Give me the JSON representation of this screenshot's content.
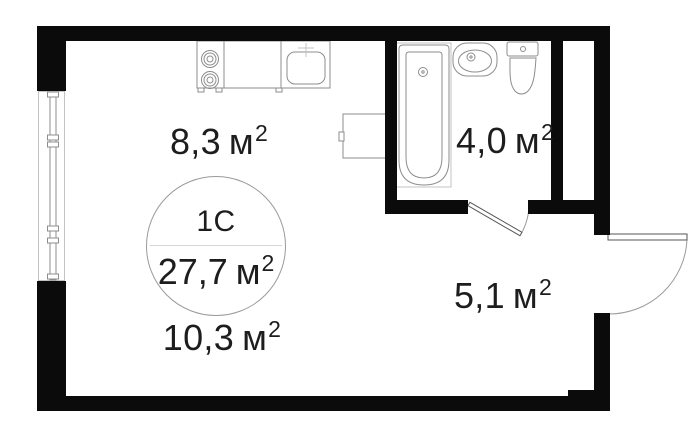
{
  "plan": {
    "stamp": {
      "type_label": "1С",
      "total_area": "27,7"
    },
    "unit": "м",
    "sup": "2",
    "rooms": [
      {
        "id": "kitchen-zone",
        "area": "8,3"
      },
      {
        "id": "bathroom",
        "area": "4,0"
      },
      {
        "id": "hallway",
        "area": "5,1"
      },
      {
        "id": "living-zone",
        "area": "10,3"
      }
    ],
    "colors": {
      "wall": "#0b0b0b",
      "fixture_line": "#8d8d8d",
      "light_line": "#c3c3c3",
      "text": "#1d1d1d",
      "background": "#ffffff"
    }
  }
}
